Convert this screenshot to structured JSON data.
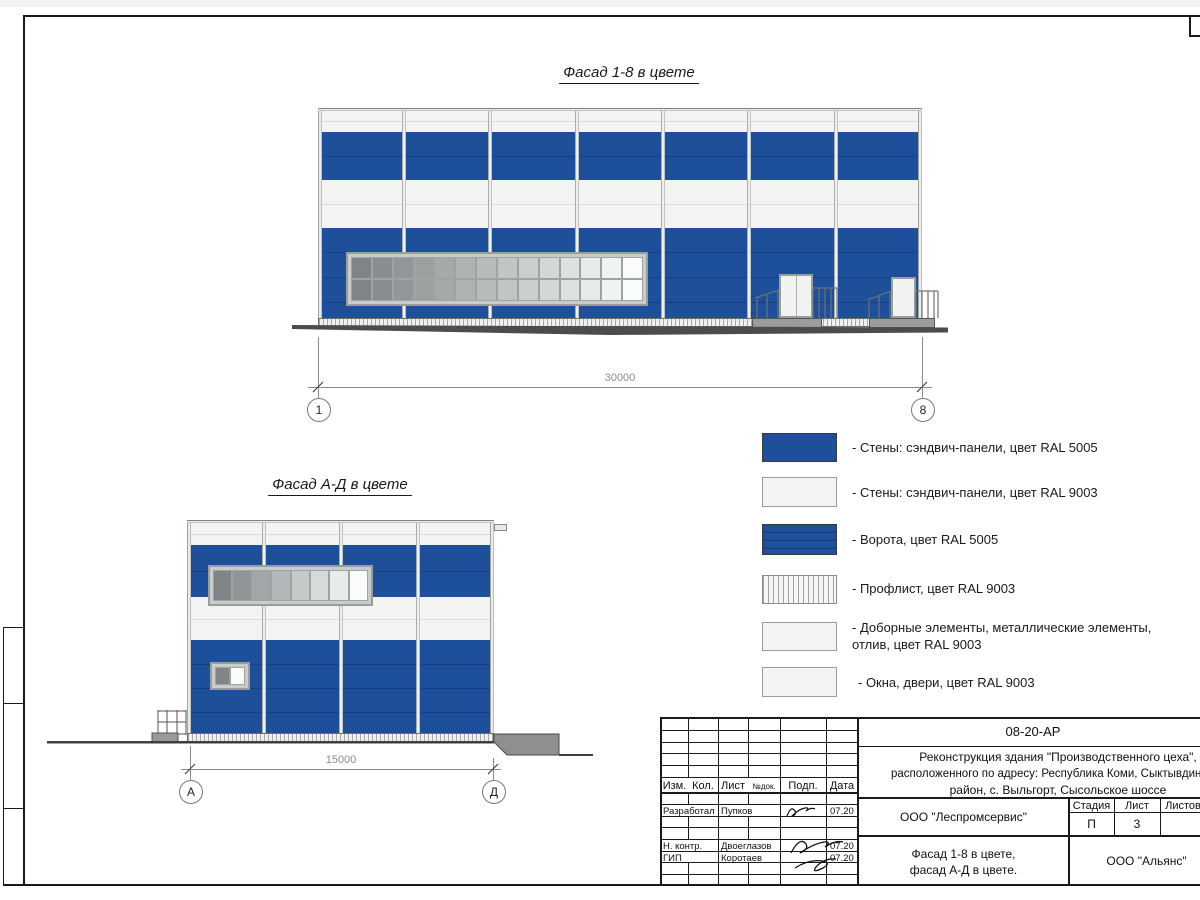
{
  "sheet": {
    "colors": {
      "ral5005": "#1E4F9B",
      "ral9003": "#F2F4F1"
    },
    "facade18": {
      "title": "Фасад 1-8 в цвете",
      "dim_label": "30000",
      "axis_left": "1",
      "axis_right": "8",
      "window": {
        "cols": 14,
        "rows": 2
      }
    },
    "facadeAD": {
      "title": "Фасад А-Д в цвете",
      "dim_label": "15000",
      "axis_left": "А",
      "axis_right": "Д",
      "window": {
        "cols": 8,
        "rows": 1
      },
      "small_window": {
        "cols": 2,
        "rows": 1
      }
    },
    "legend": {
      "items": [
        {
          "swatch": "blue-solid",
          "label": "- Стены: сэндвич-панели, цвет RAL 5005"
        },
        {
          "swatch": "white-solid",
          "label": "- Стены: сэндвич-панели, цвет RAL 9003"
        },
        {
          "swatch": "blue-gate",
          "label": "- Ворота, цвет RAL 5005"
        },
        {
          "swatch": "white-hatch",
          "label": "- Профлист, цвет RAL 9003"
        },
        {
          "swatch": "white-solid",
          "label": "- Доборные элементы, металлические элементы, отлив, цвет RAL 9003"
        },
        {
          "swatch": "white-solid",
          "label": "- Окна, двери, цвет RAL 9003"
        }
      ]
    },
    "title_block": {
      "doc_code": "08-20-АР",
      "project_line1": "Реконструкция здания \"Производственного цеха\",",
      "project_line2": "расположенного по адресу: Республика Коми, Сыктывдинский",
      "project_line3": "район, с. Выльгорт, Сысольское шоссе",
      "header": {
        "izm": "Изм.",
        "kol": "Кол.",
        "list": "Лист",
        "ndok": "№док.",
        "podp": "Подп.",
        "data": "Дата"
      },
      "rows": [
        {
          "role": "Разработал",
          "name": "Пупков",
          "date": "07.20"
        },
        {
          "role": "Н. контр.",
          "name": "Двоеглазов",
          "date": "07.20"
        },
        {
          "role": "ГИП",
          "name": "Коротаев",
          "date": "07.20"
        }
      ],
      "org": "ООО \"Леспромсервис\"",
      "stage_header": {
        "stage": "Стадия",
        "sheet": "Лист",
        "sheets": "Листов"
      },
      "stage_values": {
        "stage": "П",
        "sheet": "3",
        "sheets": ""
      },
      "subject_line1": "Фасад 1-8 в цвете,",
      "subject_line2": "фасад А-Д в цвете.",
      "contractor": "ООО \"Альянс\""
    }
  }
}
